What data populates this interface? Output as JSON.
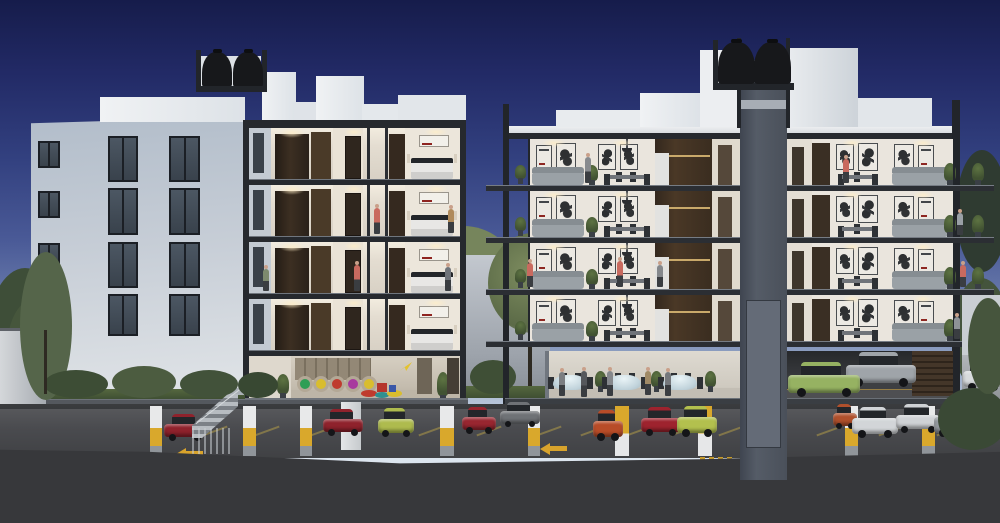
{
  "scene": {
    "type": "architectural-dusk-render",
    "description": "Cross-section rendering at dusk of two white apartment buildings over an open parking level; left building shows bedrooms and a kids playroom, right building shows living/dining floors, an event room with round tables, an elevator shaft with rooftop water tanks, and parked cars below.",
    "palette": {
      "sky_top": "#161c4b",
      "sky_mid": "#32407f",
      "sky_horizon": "#dbe4ee",
      "building_light": "#eef0f3",
      "building_shade": "#b4bfcc",
      "frame_dark": "#26292e",
      "slab_gray": "#54585e",
      "interior_wall": "#ece6db",
      "wood_dark": "#33281e",
      "shaft_gray": "#4a505b",
      "tank_black": "#17181b",
      "grass_green": "#49593b",
      "parking_floor": "#4a4b4f",
      "marking_yellow": "#d8a32c",
      "foreground_dark": "#37383b"
    },
    "left_building": {
      "water_tanks": 2,
      "windows": [
        {
          "x": 38,
          "y": 141,
          "w": 22,
          "h": 27
        },
        {
          "x": 38,
          "y": 191,
          "w": 22,
          "h": 27
        },
        {
          "x": 38,
          "y": 243,
          "w": 22,
          "h": 26
        },
        {
          "x": 108,
          "y": 136,
          "w": 30,
          "h": 46
        },
        {
          "x": 108,
          "y": 188,
          "w": 30,
          "h": 47
        },
        {
          "x": 108,
          "y": 242,
          "w": 30,
          "h": 46
        },
        {
          "x": 108,
          "y": 294,
          "w": 30,
          "h": 42
        },
        {
          "x": 169,
          "y": 136,
          "w": 31,
          "h": 46
        },
        {
          "x": 169,
          "y": 188,
          "w": 31,
          "h": 47
        },
        {
          "x": 169,
          "y": 242,
          "w": 31,
          "h": 46
        },
        {
          "x": 169,
          "y": 294,
          "w": 31,
          "h": 42
        }
      ],
      "section_floors": [
        {
          "y": 128
        },
        {
          "y": 185
        },
        {
          "y": 242
        },
        {
          "y": 299
        }
      ],
      "playroom": {
        "label": "kids-playroom",
        "nook_colors": [
          "#2e9e55",
          "#d9bd2e",
          "#bf3b2e",
          "#a83a9e",
          "#d9bd2e"
        ],
        "nook_xs": [
          48,
          64,
          80,
          96,
          112
        ]
      }
    },
    "right_building": {
      "water_tanks": 2,
      "elevator_shaft": true,
      "floors": [
        {
          "y": 139
        },
        {
          "y": 191
        },
        {
          "y": 243
        },
        {
          "y": 295
        }
      ],
      "event_room": {
        "tables": [
          {
            "x": 8
          },
          {
            "x": 62
          },
          {
            "x": 118
          }
        ]
      },
      "garage_door_slats": true
    },
    "courtyard": {
      "tree": true,
      "grass": true
    },
    "trees_back": [
      {
        "x": -14,
        "y": 268,
        "w": 78,
        "h": 150,
        "c": "#3e4e38"
      },
      {
        "x": 6,
        "y": 300,
        "w": 52,
        "h": 112,
        "c": "#46563c"
      },
      {
        "x": 414,
        "y": 226,
        "w": 98,
        "h": 78,
        "c": "#76855c"
      },
      {
        "x": 428,
        "y": 268,
        "w": 82,
        "h": 62,
        "c": "#5d6c49"
      },
      {
        "x": 956,
        "y": 150,
        "w": 52,
        "h": 122,
        "c": "#2f3b31"
      },
      {
        "x": 952,
        "y": 278,
        "w": 58,
        "h": 112,
        "c": "#44543c"
      }
    ],
    "foliage_front": [
      {
        "x": 20,
        "y": 252,
        "w": 52,
        "h": 148,
        "c": "#55654a"
      },
      {
        "x": 44,
        "y": 370,
        "w": 64,
        "h": 28,
        "c": "#3d4d35"
      },
      {
        "x": 112,
        "y": 366,
        "w": 64,
        "h": 32,
        "c": "#4c5c40"
      },
      {
        "x": 180,
        "y": 370,
        "w": 58,
        "h": 28,
        "c": "#42523a"
      },
      {
        "x": 238,
        "y": 372,
        "w": 40,
        "h": 26,
        "c": "#384832"
      },
      {
        "x": 938,
        "y": 388,
        "w": 70,
        "h": 62,
        "c": "#3a4935"
      },
      {
        "x": 968,
        "y": 298,
        "w": 40,
        "h": 96,
        "c": "#46553d"
      }
    ],
    "parking": {
      "columns_a": [
        {
          "x": 150,
          "w": 12
        },
        {
          "x": 243,
          "w": 13
        },
        {
          "x": 300,
          "w": 12
        },
        {
          "x": 440,
          "w": 14
        },
        {
          "x": 528,
          "w": 12
        },
        {
          "x": 845,
          "w": 13
        },
        {
          "x": 922,
          "w": 13
        }
      ],
      "columns_b": [
        {
          "x": 341,
          "w": 20
        }
      ],
      "columns_c": [
        {
          "x": 615,
          "w": 14
        },
        {
          "x": 698,
          "w": 14
        }
      ],
      "stall_xs": [
        214,
        266,
        322,
        430,
        488,
        548,
        592,
        638,
        682,
        730,
        828,
        890,
        948
      ],
      "cars": [
        {
          "x": 164,
          "y": 414,
          "w": 42,
          "h": 26,
          "c": "#8f222c"
        },
        {
          "x": 323,
          "y": 409,
          "w": 40,
          "h": 26,
          "c": "#8f222c"
        },
        {
          "x": 378,
          "y": 408,
          "w": 36,
          "h": 28,
          "c": "#aebb4e"
        },
        {
          "x": 462,
          "y": 407,
          "w": 34,
          "h": 26,
          "c": "#982630"
        },
        {
          "x": 500,
          "y": 402,
          "w": 40,
          "h": 24,
          "c": "#6f7276"
        },
        {
          "x": 593,
          "y": 410,
          "w": 30,
          "h": 30,
          "c": "#b84c28"
        },
        {
          "x": 641,
          "y": 407,
          "w": 40,
          "h": 28,
          "c": "#9e232e"
        },
        {
          "x": 677,
          "y": 406,
          "w": 40,
          "h": 30,
          "c": "#b3c04e"
        },
        {
          "x": 833,
          "y": 404,
          "w": 24,
          "h": 24,
          "c": "#b0502c"
        },
        {
          "x": 852,
          "y": 407,
          "w": 46,
          "h": 30,
          "c": "#d2d5d8"
        },
        {
          "x": 896,
          "y": 404,
          "w": 44,
          "h": 28,
          "c": "#cfd2d5"
        },
        {
          "x": 934,
          "y": 406,
          "w": 42,
          "h": 30,
          "c": "#93989e"
        },
        {
          "x": 846,
          "y": 352,
          "w": 70,
          "h": 34,
          "c": "#9fa4a9"
        },
        {
          "x": 788,
          "y": 362,
          "w": 72,
          "h": 34,
          "c": "#96b262"
        },
        {
          "x": 963,
          "y": 360,
          "w": 40,
          "h": 30,
          "c": "#d8dbdd"
        }
      ]
    },
    "people": [
      {
        "x": 377,
        "y": 234,
        "h": 26,
        "c": "#c96a5f"
      },
      {
        "x": 451,
        "y": 233,
        "h": 24,
        "c": "#b08a5a"
      },
      {
        "x": 357,
        "y": 291,
        "h": 26,
        "c": "#c96a5f"
      },
      {
        "x": 448,
        "y": 291,
        "h": 24,
        "c": "#70747a"
      },
      {
        "x": 266,
        "y": 291,
        "h": 22,
        "c": "#7d8a6e"
      },
      {
        "x": 588,
        "y": 183,
        "h": 26,
        "c": "#888b8f"
      },
      {
        "x": 846,
        "y": 183,
        "h": 24,
        "c": "#c96a5f"
      },
      {
        "x": 960,
        "y": 235,
        "h": 22,
        "c": "#9aa0a6"
      },
      {
        "x": 530,
        "y": 287,
        "h": 24,
        "c": "#c96a5f"
      },
      {
        "x": 620,
        "y": 287,
        "h": 26,
        "c": "#c96a5f"
      },
      {
        "x": 660,
        "y": 287,
        "h": 22,
        "c": "#85888c"
      },
      {
        "x": 963,
        "y": 287,
        "h": 22,
        "c": "#c96a5f"
      },
      {
        "x": 957,
        "y": 339,
        "h": 22,
        "c": "#8e9296"
      },
      {
        "x": 562,
        "y": 396,
        "h": 24,
        "c": "#7b7e82"
      },
      {
        "x": 584,
        "y": 397,
        "h": 26,
        "c": "#55585c"
      },
      {
        "x": 610,
        "y": 396,
        "h": 25,
        "c": "#85888c"
      },
      {
        "x": 648,
        "y": 395,
        "h": 24,
        "c": "#a08a66"
      },
      {
        "x": 668,
        "y": 396,
        "h": 24,
        "c": "#75787c"
      }
    ]
  }
}
